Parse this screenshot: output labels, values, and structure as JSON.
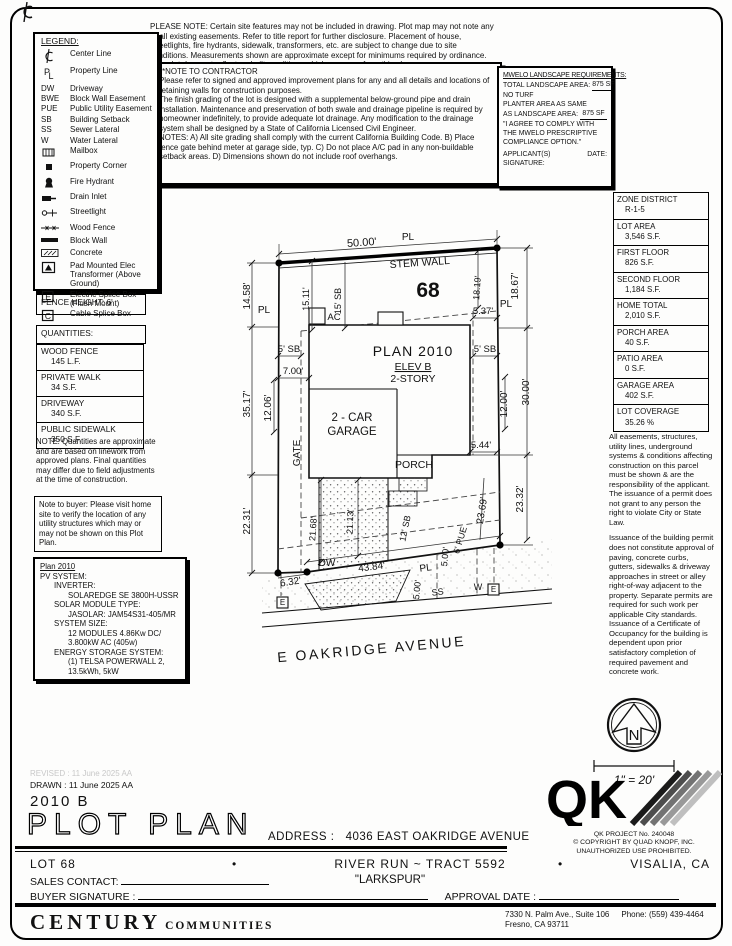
{
  "doc": {
    "please_note": "PLEASE NOTE:  Certain site features may not be included in drawing.  Plot map may not note any or all existing easements.  Refer to title report for further disclosure.  Placement of house, streetlights, fire hydrants, sidewalk, transformers, etc. are subject to change due to site conditions.  Measurements shown are approximate except for minimums required by ordinance.  This plot does not reflect as-built conditions which may vary from this plan."
  },
  "contractor": {
    "heading": "**NOTE TO CONTRACTOR",
    "paras": [
      "Please refer to signed and approved improvement plans for any and all details and locations of retaining walls for construction purposes.",
      "The finish grading of the lot is designed with a supplemental below-ground pipe and drain installation.  Maintenance and preservation of both swale and drainage pipeline is required by homeowner indefinitely, to provide adequate lot drainage.  Any modification to the drainage system shall be designed by a State of California Licensed Civil Engineer.",
      "NOTES:   A) All site grading shall comply with the current California Building Code. B) Place fence gate behind meter at garage side, typ.  C) Do not place A/C pad in any non-buildable setback areas.  D) Dimensions shown do not include roof overhangs."
    ]
  },
  "mwelo": {
    "heading": "MWELO LANDSCAPE REQUIREMENTS:",
    "total_label": "TOTAL LANDSCAPE AREA:",
    "total_value": "875 SF",
    "no_turf": "NO TURF",
    "planter_line1": "PLANTER AREA AS SAME",
    "planter_line2": "AS LANDSCAPE AREA:",
    "planter_value": "875 SF",
    "quote": "\"I AGREE TO COMPLY WITH THE MWELO PRESCRIPTIVE COMPLIANCE OPTION.\"",
    "sig_label": "APPLICANT(S) SIGNATURE:",
    "date_label": "DATE:"
  },
  "legend": {
    "heading": "LEGEND:",
    "items": [
      {
        "icon": "centerline-icon",
        "label": "Center Line"
      },
      {
        "icon": "propertyline-icon",
        "label": "Property Line"
      },
      {
        "sym": "DW",
        "label": "Driveway"
      },
      {
        "sym": "BWE",
        "label": "Block Wall Easement"
      },
      {
        "sym": "PUE",
        "label": "Public Utility Easement"
      },
      {
        "sym": "SB",
        "label": "Building Setback"
      },
      {
        "sym": "SS",
        "label": "Sewer Lateral"
      },
      {
        "sym": "W",
        "label": "Water Lateral"
      },
      {
        "icon": "mailbox-icon",
        "label": "Mailbox"
      },
      {
        "icon": "property-corner-icon",
        "label": "Property Corner"
      },
      {
        "icon": "fire-hydrant-icon",
        "label": "Fire Hydrant"
      },
      {
        "icon": "drain-inlet-icon",
        "label": "Drain Inlet"
      },
      {
        "icon": "streetlight-icon",
        "label": "Streetlight"
      },
      {
        "icon": "wood-fence-icon",
        "label": "Wood Fence"
      },
      {
        "icon": "block-wall-icon",
        "label": "Block Wall"
      },
      {
        "icon": "concrete-icon",
        "label": "Concrete"
      },
      {
        "icon": "pad-transformer-icon",
        "label": "Pad Mounted Elec Transformer (Above Ground)"
      },
      {
        "icon": "electric-splice-icon",
        "label": "Electric Splice Box (Flush Mount)"
      },
      {
        "icon": "cable-splice-icon",
        "label": "Cable Splice Box"
      }
    ]
  },
  "fence": {
    "label": "FENCE HEIGHT: 6'"
  },
  "quantities": {
    "heading": "QUANTITIES:",
    "rows": [
      {
        "label": "WOOD FENCE",
        "value": "145 L.F."
      },
      {
        "label": "PRIVATE WALK",
        "value": "34 S.F."
      },
      {
        "label": "DRIVEWAY",
        "value": "340 S.F."
      },
      {
        "label": "PUBLIC SIDEWALK",
        "value": "350 S.F."
      }
    ],
    "note": "NOTE: Quantities are approximate and are based on linework from approved plans. Final quantities may differ due to field adjustments at the time of construction."
  },
  "buyer_note": "Note to buyer: Please visit home site to verify the location of any utility structures which may or may not be shown on this Plot Plan.",
  "pv": {
    "lines": [
      {
        "t": "Plan 2010",
        "i": 0,
        "u": 1
      },
      {
        "t": "PV SYSTEM:",
        "i": 0
      },
      {
        "t": "INVERTER:",
        "i": 1
      },
      {
        "t": "SOLAREDGE SE 3800H-USSR",
        "i": 2
      },
      {
        "t": "SOLAR MODULE TYPE:",
        "i": 1
      },
      {
        "t": "JASOLAR: JAM54S31-405/MR",
        "i": 2
      },
      {
        "t": "SYSTEM SIZE:",
        "i": 1
      },
      {
        "t": "12 MODULES 4.86Kw DC/",
        "i": 2
      },
      {
        "t": "3.800kW AC (405w)",
        "i": 2
      },
      {
        "t": "ENERGY STORAGE SYSTEM:",
        "i": 1
      },
      {
        "t": "(1) TELSA POWERWALL 2,",
        "i": 2
      },
      {
        "t": "13.5kWh, 5kW",
        "i": 2
      }
    ]
  },
  "zone": {
    "rows": [
      [
        "ZONE DISTRICT",
        "R-1-5"
      ],
      [
        "LOT AREA",
        "3,546 S.F."
      ],
      [
        "FIRST FLOOR",
        "826 S.F."
      ],
      [
        "SECOND FLOOR",
        "1,184 S.F."
      ],
      [
        "HOME TOTAL",
        "2,010 S.F."
      ],
      [
        "PORCH AREA",
        "40 S.F."
      ],
      [
        "PATIO AREA",
        "0 S.F."
      ],
      [
        "GARAGE AREA",
        "402 S.F."
      ],
      [
        "LOT COVERAGE",
        "35.26 %"
      ]
    ]
  },
  "right_notes": [
    "All easements, structures, utility lines, underground systems & conditions affecting construction on this parcel must be shown & are the responsibility of the applicant. The issuance of a permit does not grant to any person the right to violate City or State Law.",
    "Issuance of the building permit does not constitute approval of paving, concrete curbs, gutters, sidewalks & driveway approaches in street or alley right-of-way adjacent to the property. Separate permits are required for such work per applicable City standards. Issuance of a Certificate of Occupancy for the building is dependent upon prior satisfactory completion of required pavement and concrete work."
  ],
  "plot": {
    "labels": [
      {
        "t": "50.00'",
        "x": 362,
        "y": 246,
        "r": -4,
        "s": 11
      },
      {
        "t": "PL",
        "x": 408,
        "y": 240,
        "s": 10
      },
      {
        "t": "STEM WALL",
        "x": 420,
        "y": 266,
        "r": -4,
        "s": 10.5
      },
      {
        "t": "68",
        "x": 428,
        "y": 297,
        "s": 21,
        "w": 700
      },
      {
        "t": "PL",
        "x": 264,
        "y": 313,
        "s": 10
      },
      {
        "t": "14.58'",
        "x": 250,
        "y": 296,
        "r": -90,
        "s": 10
      },
      {
        "t": "15.11'",
        "x": 309,
        "y": 299,
        "r": -90,
        "s": 9
      },
      {
        "t": "15' SB",
        "x": 341,
        "y": 301,
        "r": -90,
        "s": 9
      },
      {
        "t": "18.19'",
        "x": 480,
        "y": 288,
        "r": -86,
        "s": 9
      },
      {
        "t": "18.67'",
        "x": 518,
        "y": 286,
        "r": -90,
        "s": 10
      },
      {
        "t": "PL",
        "x": 506,
        "y": 307,
        "s": 10
      },
      {
        "t": "5.37'",
        "x": 483,
        "y": 314,
        "s": 9.5
      },
      {
        "t": "AC",
        "x": 334,
        "y": 320,
        "s": 9.5
      },
      {
        "t": "5' SB",
        "x": 289,
        "y": 352,
        "s": 9.5
      },
      {
        "t": "5' SB",
        "x": 485,
        "y": 352,
        "s": 9.5
      },
      {
        "t": "PLAN 2010",
        "x": 413,
        "y": 356,
        "s": 14,
        "ls": 1
      },
      {
        "t": "ELEV B",
        "x": 413,
        "y": 370,
        "s": 10.5,
        "u": 1
      },
      {
        "t": "2-STORY",
        "x": 413,
        "y": 382,
        "s": 10.5
      },
      {
        "t": "7.00'",
        "x": 293,
        "y": 374,
        "s": 9.5
      },
      {
        "t": "35.17'",
        "x": 250,
        "y": 404,
        "r": -90,
        "s": 10
      },
      {
        "t": "12.06'",
        "x": 271,
        "y": 408,
        "r": -90,
        "s": 10
      },
      {
        "t": "30.00'",
        "x": 529,
        "y": 392,
        "r": -90,
        "s": 10
      },
      {
        "t": "12.00'",
        "x": 507,
        "y": 404,
        "r": -90,
        "s": 10
      },
      {
        "t": "GATE",
        "x": 300,
        "y": 453,
        "r": -90,
        "s": 10
      },
      {
        "t": "2 - CAR",
        "x": 352,
        "y": 421,
        "s": 11.5
      },
      {
        "t": "GARAGE",
        "x": 352,
        "y": 435,
        "s": 11.5
      },
      {
        "t": "PORCH",
        "x": 414,
        "y": 468,
        "s": 10.5
      },
      {
        "t": "5.44'",
        "x": 481,
        "y": 448,
        "s": 9.5
      },
      {
        "t": "23.69'",
        "x": 485,
        "y": 511,
        "r": -81,
        "s": 10
      },
      {
        "t": "23.32'",
        "x": 523,
        "y": 499,
        "r": -90,
        "s": 10
      },
      {
        "t": "12' SB",
        "x": 408,
        "y": 529,
        "r": -78,
        "s": 9
      },
      {
        "t": "6' PUE",
        "x": 463,
        "y": 541,
        "r": -73,
        "s": 9
      },
      {
        "t": "21.68'",
        "x": 316,
        "y": 529,
        "r": -86,
        "s": 9
      },
      {
        "t": "21.13'",
        "x": 353,
        "y": 522,
        "r": -88,
        "s": 9
      },
      {
        "t": "DW",
        "x": 327,
        "y": 566,
        "s": 10
      },
      {
        "t": "43.84'",
        "x": 372,
        "y": 570,
        "r": -7,
        "s": 10
      },
      {
        "t": "6.32'",
        "x": 291,
        "y": 585,
        "r": -9,
        "s": 10
      },
      {
        "t": "PL",
        "x": 426,
        "y": 571,
        "r": -7,
        "s": 10
      },
      {
        "t": "5.00'",
        "x": 448,
        "y": 557,
        "r": -84,
        "s": 9
      },
      {
        "t": "5.00'",
        "x": 420,
        "y": 590,
        "r": -84,
        "s": 9
      },
      {
        "t": "SS",
        "x": 438,
        "y": 595,
        "r": -7,
        "s": 9
      },
      {
        "t": "W",
        "x": 478,
        "y": 590,
        "s": 9
      },
      {
        "t": "E",
        "x": 493.5,
        "y": 592,
        "s": 8
      },
      {
        "t": "E",
        "x": 282.5,
        "y": 605,
        "s": 8
      },
      {
        "t": "22.31'",
        "x": 250,
        "y": 521,
        "r": -90,
        "s": 10
      },
      {
        "t": "E OAKRIDGE AVENUE",
        "x": 372,
        "y": 654,
        "r": -5,
        "s": 14,
        "ls": 2.5
      }
    ]
  },
  "compass": {
    "north": "N",
    "scale": "1\" = 20'"
  },
  "qk": {
    "project": "QK PROJECT No. 240048",
    "copyright": "©   COPYRIGHT BY QUAD KNOPF, INC.",
    "warn": "UNAUTHORIZED USE PROHIBITED."
  },
  "footer": {
    "revised": "REVISED :  11 June 2025   AA",
    "drawn": "DRAWN :  11 June 2025   AA",
    "plan_no": "2010 B",
    "title": "PLOT PLAN",
    "address_label": "ADDRESS :",
    "address": "4036 EAST OAKRIDGE AVENUE",
    "lot": "LOT 68",
    "bullet": "•",
    "tract": "RIVER RUN ~ TRACT 5592",
    "model": "\"LARKSPUR\"",
    "city": "VISALIA, CA",
    "sales_label": "SALES CONTACT:",
    "buyer_label": "BUYER SIGNATURE :",
    "approval_label": "APPROVAL DATE :",
    "brand": "CENTURY",
    "brand_sub": "COMMUNITIES",
    "office_addr1": "7330 N. Palm Ave., Suite 106",
    "office_phone": "Phone:  (559) 439-4464",
    "office_addr2": "Fresno, CA  93711"
  }
}
